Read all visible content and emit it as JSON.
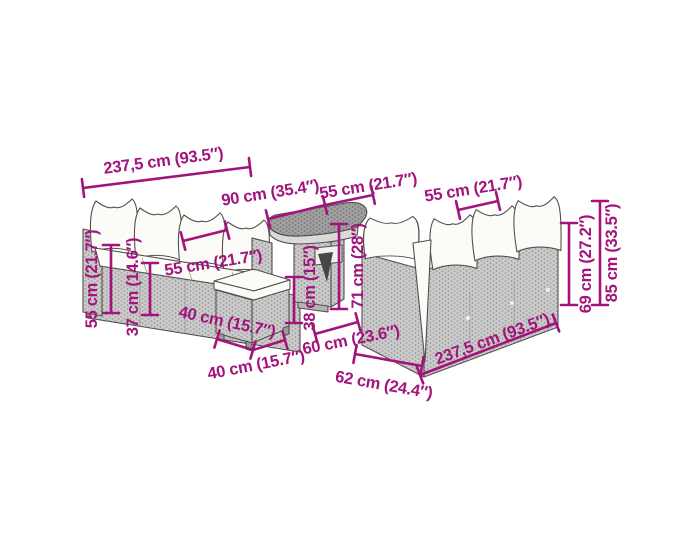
{
  "diagram": {
    "subject": "garden-lounge-set-dimension-diagram",
    "accent_color": "#A2137C",
    "background_color": "#ffffff",
    "furniture_color": "#cbcbcb"
  },
  "dims": {
    "sofa_width_top": {
      "label": "237,5 cm (93.5″)"
    },
    "corner_width_90": {
      "label": "90 cm (35.4″)"
    },
    "table_width_55": {
      "label": "55 cm (21.7″)"
    },
    "right_seat_width_55": {
      "label": "55 cm (21.7″)"
    },
    "left_seat_width_55": {
      "label": "55 cm (21.7″)"
    },
    "backrest_height_55": {
      "label": "55 cm (21.7″)"
    },
    "seat_height_37": {
      "label": "37 cm (14.6″)"
    },
    "stool_width_40": {
      "label": "40 cm (15.7″)"
    },
    "stool_depth_40": {
      "label": "40 cm (15.7″)"
    },
    "stool_height_38": {
      "label": "38 cm (15″)"
    },
    "table_height_71": {
      "label": "71 cm (28″)"
    },
    "corner_depth_60": {
      "label": "60 cm (23.6″)"
    },
    "sofa_depth_62": {
      "label": "62 cm (24.4″)"
    },
    "sofa_width_bottom": {
      "label": "237,5 cm (93.5″)"
    },
    "back_height_69": {
      "label": "69 cm (27.2″)"
    },
    "total_height_85": {
      "label": "85 cm (33.5″)"
    }
  }
}
